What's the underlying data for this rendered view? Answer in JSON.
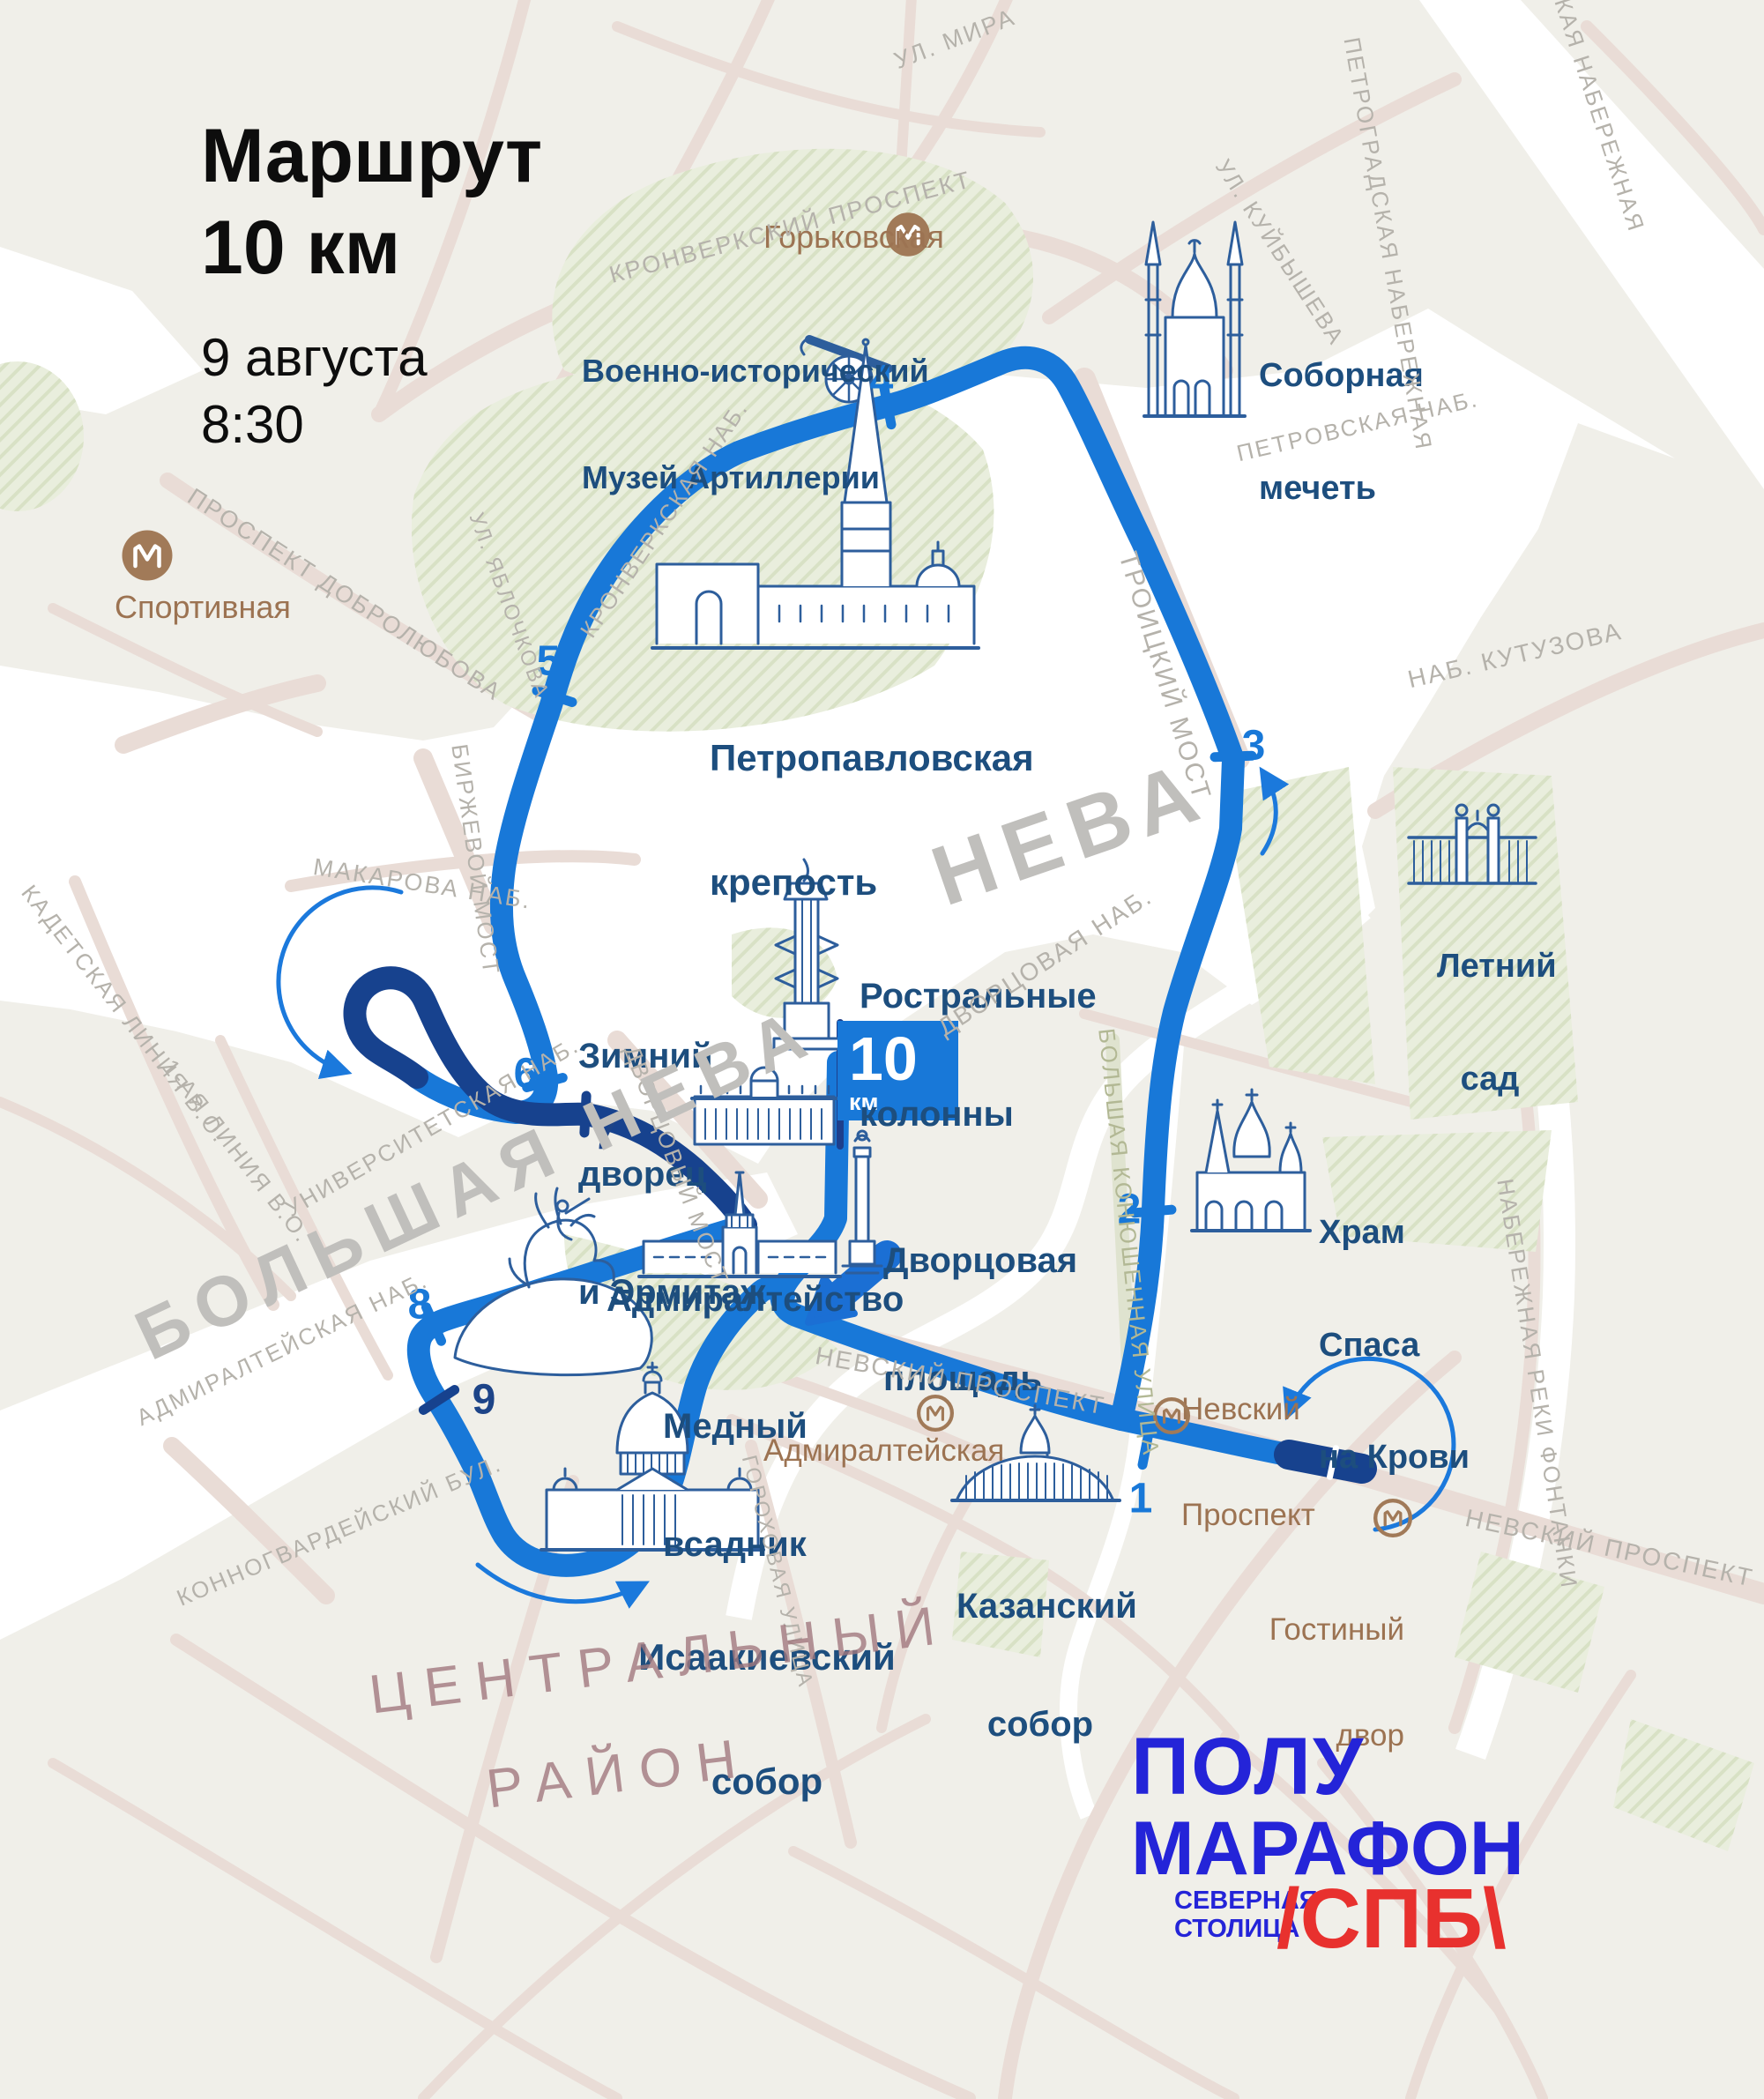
{
  "title": {
    "line1": "Маршрут",
    "line2": "10 км",
    "date": "9 августа",
    "time": "8:30"
  },
  "finish_flag": {
    "value": "10",
    "unit": "км"
  },
  "route": {
    "km": [
      "1",
      "2",
      "3",
      "4",
      "5",
      "6",
      "7",
      "8",
      "9"
    ]
  },
  "landmarks": {
    "artillery": {
      "lines": [
        "Военно-исторический",
        "Музей Артиллерии"
      ]
    },
    "mosque": {
      "lines": [
        "Соборная",
        "мечеть"
      ]
    },
    "fortress": {
      "lines": [
        "Петропавловская",
        "крепость"
      ]
    },
    "rostral": {
      "lines": [
        "Ростральные",
        "колонны"
      ]
    },
    "hermitage": {
      "lines": [
        "Зимний",
        "дворец",
        "и Эрмитаж"
      ]
    },
    "palace_square": {
      "lines": [
        "Дворцовая",
        "площадь"
      ]
    },
    "summer_garden": {
      "lines": [
        "Летний",
        "сад"
      ]
    },
    "savior": {
      "lines": [
        "Храм",
        "Спаса",
        "на Крови"
      ]
    },
    "admiralty": {
      "lines": [
        "Адмиралтейство"
      ]
    },
    "horseman": {
      "lines": [
        "Медный",
        "всадник"
      ]
    },
    "isaac": {
      "lines": [
        "Исаакиевский",
        "собор"
      ]
    },
    "kazan": {
      "lines": [
        "Казанский",
        "собор"
      ]
    }
  },
  "metro_stations": {
    "sportivnaya": {
      "name": "Спортивная"
    },
    "gorkovskaya": {
      "name": "Горьковская"
    },
    "nevsky_prospekt": {
      "lines": [
        "Невский",
        "Проспект"
      ]
    },
    "admiralteyskaya": {
      "name": "Адмиралтейская"
    },
    "gostiny_dvor": {
      "lines": [
        "Гостиный",
        "двор"
      ]
    }
  },
  "streets": {
    "ul_mira": "УЛ. МИРА",
    "kronverksky_prospekt": "КРОНВЕРКСКИЙ ПРОСПЕКТ",
    "kuybysheva": "УЛ. КУЙБЫШЕВА",
    "petrogradskaya_nab": "ПЕТРОГРАДСКАЯ НАБЕРЕЖНАЯ",
    "kaya_nab": "КАЯ НАБЕРЕЖНАЯ",
    "petrovskaya_nab": "ПЕТРОВСКАЯ НАБ.",
    "nab_kutuzova": "НАБ. КУТУЗОВА",
    "troitsky_most": "ТРОИЦКИЙ МОСТ",
    "kronverkskaya_nab": "КРОНВЕРКСКАЯ НАБ.",
    "yablochkova": "УЛ. ЯБЛОЧКОВА",
    "dobrolyubova": "ПРОСПЕКТ ДОБРОЛЮБОВА",
    "makarova_nab": "МАКАРОВА НАБ.",
    "birzhevoy_most": "БИРЖЕВОЙ МОСТ",
    "dvortsovaya_nab": "ДВОРЦОВАЯ НАБ.",
    "dvortsovy_most": "ДВОРЦОВЫЙ МОСТ",
    "universitetskaya_nab": "УНИВЕРСИТЕТСКАЯ НАБ.",
    "kadetskaya_liniya": "КАДЕТСКАЯ ЛИНИЯ В.О.",
    "pervaya_liniya": "1-АЯ ЛИНИЯ В.О.",
    "admiralteyskaya_nab": "АДМИРАЛТЕЙСКАЯ НАБ.",
    "konnogvardeysky_bul": "КОННОГВАРДЕЙСКИЙ БУЛ.",
    "nevsky_w": "НЕВСКИЙ ПРОСПЕКТ",
    "nevsky_e": "НЕВСКИЙ ПРОСПЕКТ",
    "bolshaya_konyushennaya": "БОЛЬШАЯ КОНЮШЕННАЯ УЛИЦА",
    "fontanki": "НАБЕРЕЖНАЯ РЕКИ ФОНТАНКИ",
    "gorokhovaya": "ГОРОХОВАЯ УЛИЦА"
  },
  "water_labels": {
    "neva": "НЕВА",
    "bolshaya_neva": "БОЛЬШАЯ НЕВА"
  },
  "district": {
    "line1": "ЦЕНТРАЛЬНЫЙ",
    "line2": "РАЙОН"
  },
  "logo": {
    "top": "ПОЛУ",
    "middle": "МАРАФОН",
    "sub1": "СЕВЕРНАЯ",
    "sub2": "СТОЛИЦА",
    "right": "/СПБ\\"
  },
  "colors": {
    "route": "#1878d8",
    "route_dark": "#17428e",
    "landmark_text": "#1d4e7e",
    "metro_brown": "#a17a58",
    "street_grey": "#b5b2ab",
    "logo_blue": "#2424d8",
    "logo_red": "#e8312e",
    "water": "#ffffff",
    "park": "#e9eedd",
    "road": "#e9dcd6"
  }
}
